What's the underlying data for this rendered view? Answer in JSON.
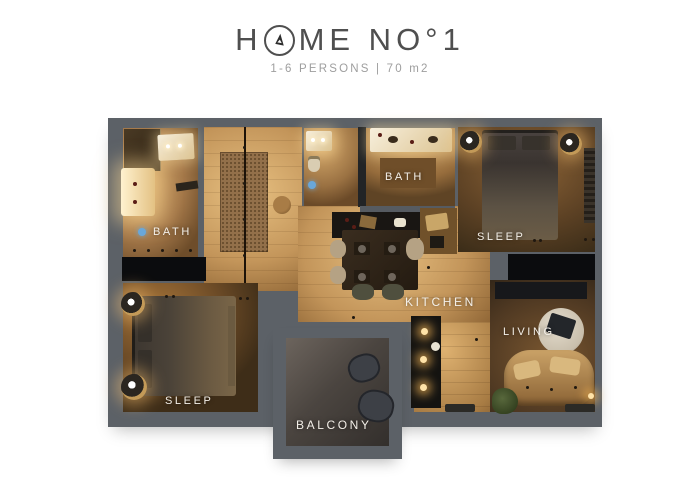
{
  "header": {
    "title_prefix": "H",
    "title_suffix": "ME NO°1",
    "subtitle": "1-6 PERSONS | 70 m2"
  },
  "icons": {
    "logo": "pine-tree-icon",
    "bath_left_marker": "shower-icon",
    "wc_marker": "shower-icon"
  },
  "rooms": {
    "bath_left": {
      "label": "BATH"
    },
    "bath_top": {
      "label": "BATH"
    },
    "sleep_main": {
      "label": "SLEEP"
    },
    "sleep_second": {
      "label": "SLEEP"
    },
    "kitchen": {
      "label": "KITCHEN"
    },
    "living": {
      "label": "LIVING"
    },
    "balcony": {
      "label": "BALCONY"
    }
  },
  "colors": {
    "background": "#ffffff",
    "walls": "#5c6167",
    "floor_wood_light": "#e7c081",
    "floor_wood_dark": "#6e4c27",
    "accent_marker_blue": "#69a7d9",
    "label_text": "#f3efe8",
    "title_text": "#4f4f4f",
    "subtitle_text": "#9e9e9e"
  }
}
